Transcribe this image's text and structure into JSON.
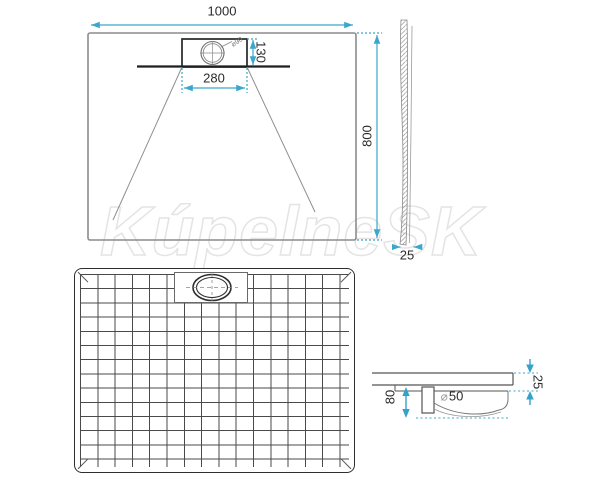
{
  "watermark": {
    "text": "KúpelneSK"
  },
  "colors": {
    "dimension": "#3aa7cb",
    "arrow_fill": "#35a3c9",
    "line_dark": "#262626",
    "line_gray": "#8c8c8c",
    "grid_line": "#4a4a4a",
    "watermark_outline": "#e4e4e4"
  },
  "top_view": {
    "width_label": "1000",
    "length_label": "800",
    "drain_box_width_label": "280",
    "drain_box_depth_label": "130",
    "drain_diameter_label": "⌀90"
  },
  "side_view": {
    "thickness_label": "25"
  },
  "drain_detail": {
    "trap_height_label": "80",
    "pipe_diameter_symbol": "⌀",
    "pipe_diameter_value": "50",
    "tray_thickness_label": "25"
  }
}
